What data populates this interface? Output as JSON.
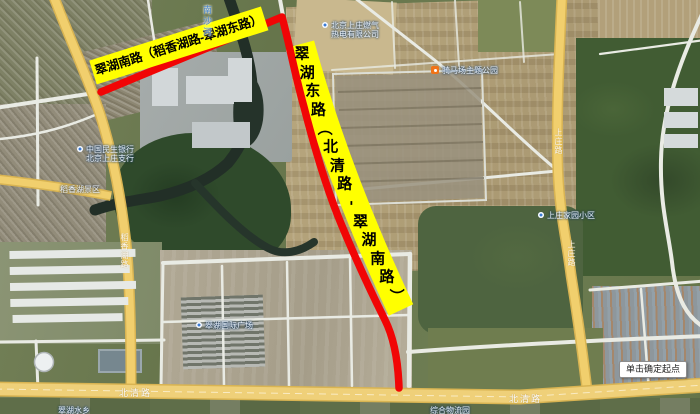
{
  "map": {
    "tooltip": "单击确定起点",
    "route": {
      "color": "#f10505",
      "label_bg": "#ffff00",
      "top_label": "翠湖南路（稻香湖路-翠湖东路）",
      "side_label": "翠湖东路（北清路-翠湖南路）"
    },
    "road_names": {
      "beiqing_w": "北清路",
      "beiqing_e": "北清路",
      "daoxianghu": "稻香湖路",
      "east_rd_1": "上庄路",
      "east_rd_2": "上庄路"
    },
    "water_name": "南沙河",
    "poi": [
      {
        "line1": "北京上庄燃气",
        "line2": "热电有限公司"
      },
      {
        "line1": "骑马场主题公园",
        "line2": ""
      },
      {
        "line1": "翠湖国际广场",
        "line2": ""
      },
      {
        "line1": "中国民生银行",
        "line2": "北京上庄支行"
      },
      {
        "line1": "上庄家园小区",
        "line2": ""
      },
      {
        "line1": "稻香湖景区",
        "line2": ""
      },
      {
        "line1": "翠湖水乡",
        "line2": ""
      },
      {
        "line1": "综合物流园",
        "line2": ""
      }
    ]
  }
}
